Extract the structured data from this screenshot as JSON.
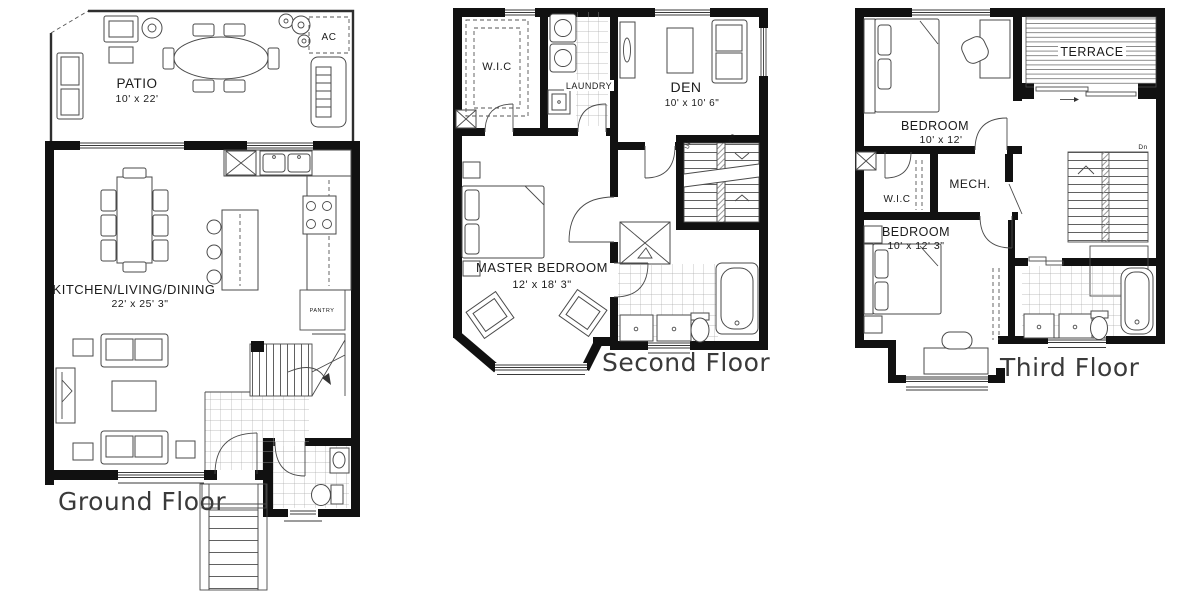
{
  "palette": {
    "wall_ink": "#111111",
    "furniture_line": "#4a4a4a",
    "muted_label": "#c3c3c3",
    "background": "#ffffff"
  },
  "floors": [
    {
      "name": "Ground Floor",
      "rooms": [
        {
          "label": "PATIO",
          "dims": "10' x 22'"
        },
        {
          "label": "KITCHEN/LIVING/DINING",
          "dims": "22' x 25' 3\""
        },
        {
          "label": "PANTRY",
          "dims": ""
        },
        {
          "label": "AC",
          "dims": ""
        }
      ]
    },
    {
      "name": "Second Floor",
      "rooms": [
        {
          "label": "W.I.C",
          "dims": ""
        },
        {
          "label": "LAUNDRY",
          "dims": ""
        },
        {
          "label": "DEN",
          "dims": "10' x 10' 6\""
        },
        {
          "label": "MASTER BEDROOM",
          "dims": "12' x 18' 3\""
        }
      ],
      "stairs": {
        "up": "UP",
        "down": "DN"
      }
    },
    {
      "name": "Third Floor",
      "rooms": [
        {
          "label": "TERRACE",
          "dims": ""
        },
        {
          "label": "BEDROOM",
          "dims": "10' x 12'"
        },
        {
          "label": "W.I.C",
          "dims": ""
        },
        {
          "label": "MECH.",
          "dims": ""
        },
        {
          "label": "BEDROOM",
          "dims": "10' x 12' 3\""
        }
      ],
      "stairs": {
        "down": "Dn"
      }
    }
  ]
}
